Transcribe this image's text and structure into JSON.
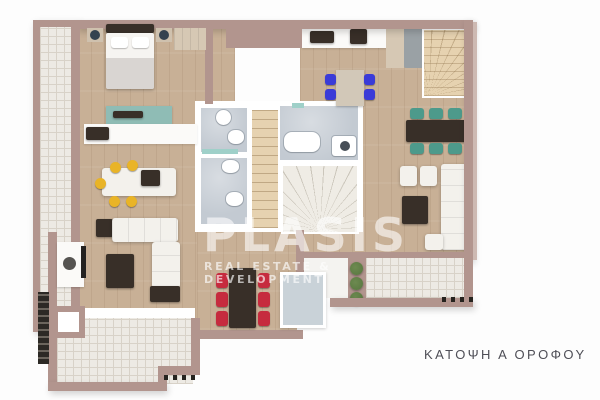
{
  "watermark": {
    "brand": "PLASIS",
    "tagline": "REAL ESTATE & DEVELOPMENT"
  },
  "caption": {
    "text": "ΚΑΤΟΨΗ Α ΟΡΟΦΟΥ"
  },
  "colors": {
    "wall": "#b2958e",
    "wall_light": "#cdb9b2",
    "wood": "#c8b096",
    "tile": "#edeae4",
    "tile_line": "#d8d2c8",
    "bathroom": "#c3cad2",
    "stair": "#e6d2b0",
    "furniture_dark": "#382f28",
    "sofa": "#f3f1ec",
    "accent_red": "#c62b3e",
    "accent_teal": "#4d9a8b",
    "accent_teal_light": "#9fd0c9",
    "accent_yellow": "#e9b427",
    "accent_blue": "#3a3bd8",
    "plant": "#57763f",
    "glass": "#c9d2d8",
    "counter_white": "#fbfaf8",
    "cabinet_wood": "#d6c8b4",
    "gray_unit": "#9aa1a5",
    "lamp_dark": "#35424f",
    "watermark_white": "#ffffff",
    "caption_text": "#4e4e56"
  }
}
